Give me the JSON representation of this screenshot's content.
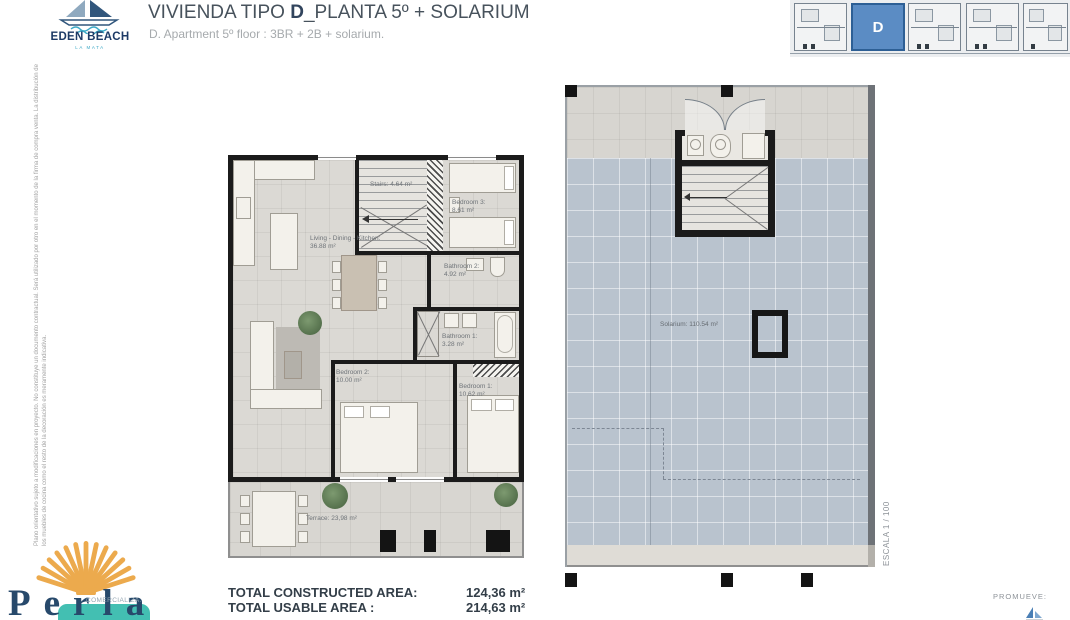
{
  "header": {
    "logo_name": "EDEN BEACH",
    "logo_sub": "LA MATA",
    "title_prefix": "VIVIENDA TIPO ",
    "title_bold": "D",
    "title_suffix": "_PLANTA 5º + SOLARIUM",
    "subtitle": "D. Apartment 5º floor : 3BR + 2B + solarium.",
    "keyplan_unit": "D"
  },
  "side_notes": {
    "disclaimer": "Plano orientativo sujeto a modificaciones en proyecto. No constituye un documento contractual. Será utilizado por otro en el momento de la firma de compra venta. La distribución de los muebles de cocina como el resto de la decoración es meramente indicativa.",
    "scale": "ESCALA 1 / 100"
  },
  "floorplan": {
    "stairs": "Stairs: 4.64 m²",
    "bedroom3_name": "Bedroom 3:",
    "bedroom3_area": "8.61 m²",
    "living_name": "Living - Dining - Kitchen:",
    "living_area": "36.88 m²",
    "bathroom2_name": "Bathroom 2:",
    "bathroom2_area": "4.92 m²",
    "bathroom1_name": "Bathroom 1:",
    "bathroom1_area": "3.28 m²",
    "bedroom2_name": "Bedroom 2:",
    "bedroom2_area": "10.00 m²",
    "bedroom1_name": "Bedroom 1:",
    "bedroom1_area": "10.62 m²",
    "terrace": "Terrace: 23,98 m²"
  },
  "solarium_plan": {
    "label": "Solarium: 110.54 m²"
  },
  "totals": {
    "constructed_label": "TOTAL CONSTRUCTED AREA:",
    "constructed_value": "124,36 m²",
    "usable_label": "TOTAL USABLE AREA :",
    "usable_value": "214,63 m²"
  },
  "footer": {
    "comercializa_label": "COMERCIALIZA:",
    "comercializa_brand": "Perla",
    "promueve_label": "PROMUEVE:"
  },
  "colors": {
    "unit_highlight": "#5b8cc4",
    "brand_navy": "#27496b",
    "shell_orange": "#ecaa4d",
    "brand_teal": "#43bfb2",
    "solarium_deck": "#b9c3ce"
  }
}
